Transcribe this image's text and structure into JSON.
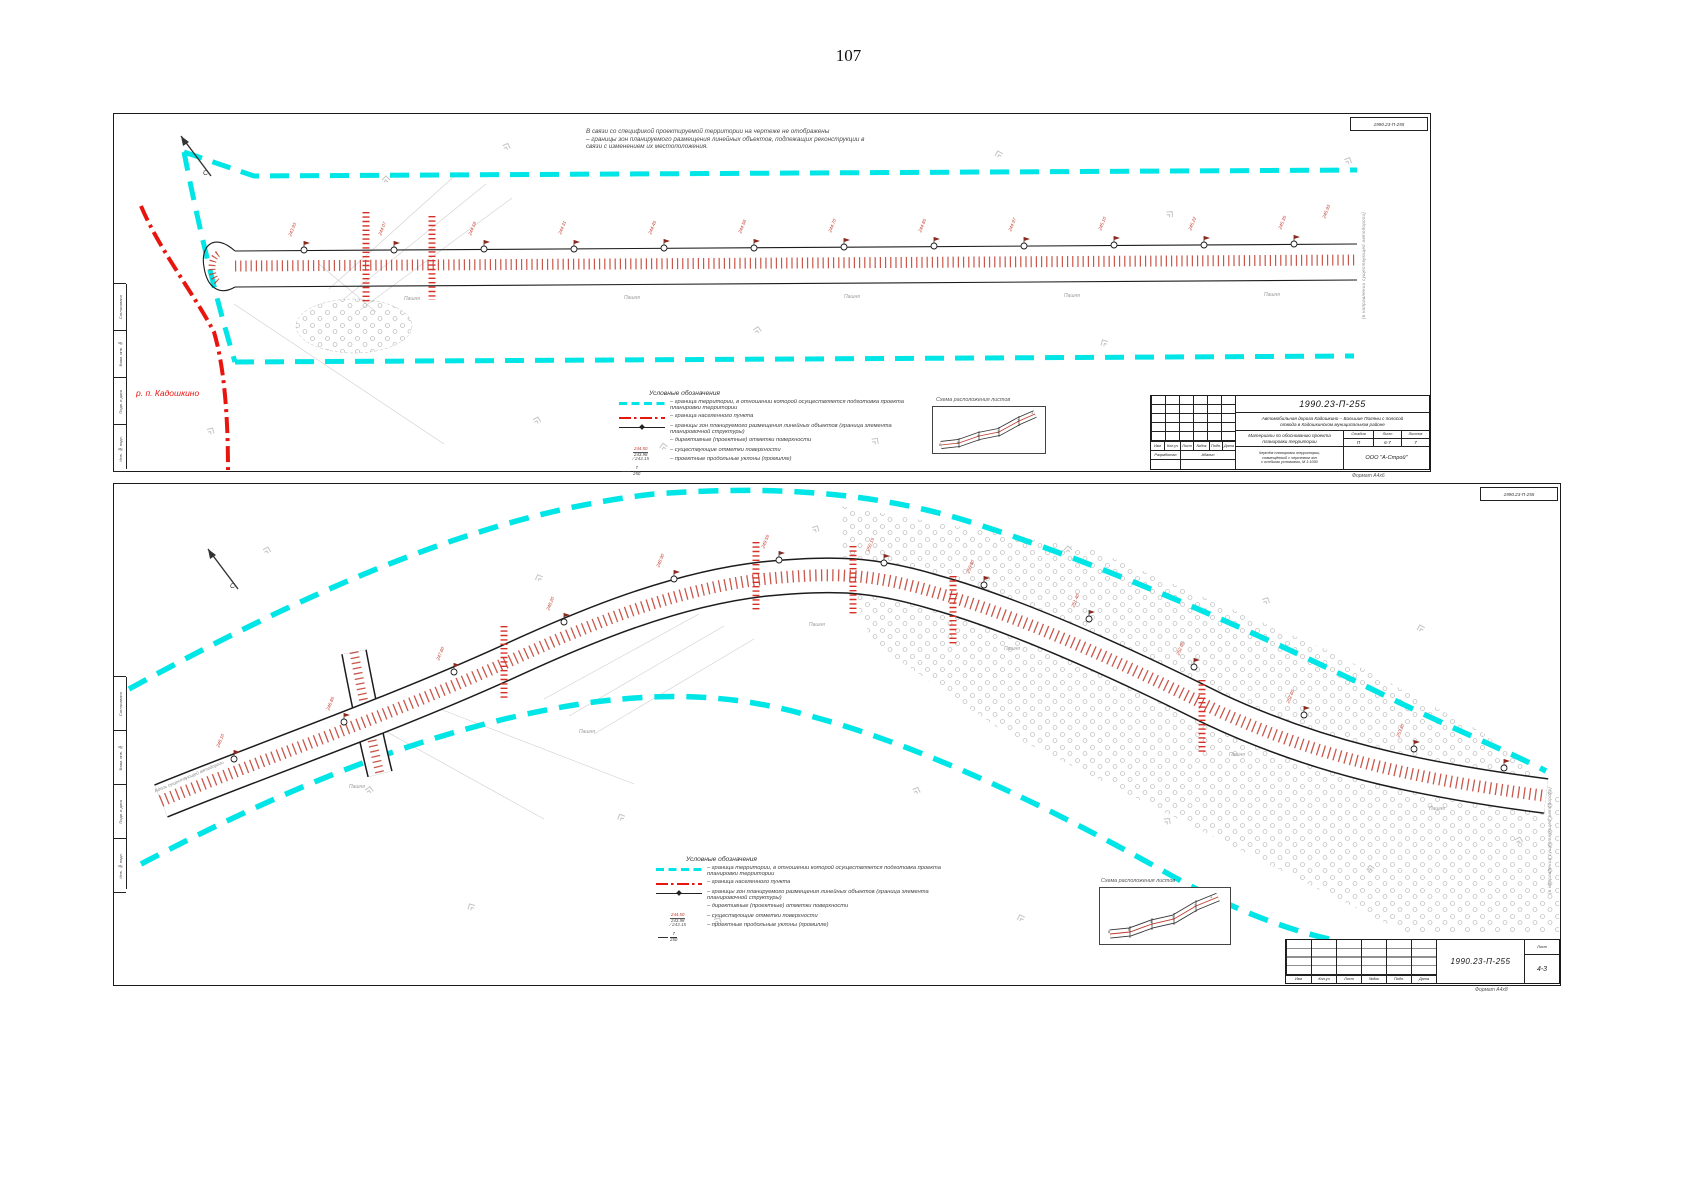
{
  "page": {
    "number": "107"
  },
  "colors": {
    "boundary_cyan": "#00E5E6",
    "settlement_red": "#E8150F",
    "road_hatch_red": "#C0392B",
    "line_black": "#1C1C1C",
    "muted_gray": "#9B9B9B"
  },
  "stamp_labels": {
    "approved": "Согласовано",
    "inv_replace": "Взам. инв. №",
    "sign_date": "Подп. и дата",
    "inv_orig": "Инв. № подл."
  },
  "legend": {
    "title": "Условные обозначения",
    "items": [
      {
        "label": "– граница территории, в отношении которой осуществляется подготовка проекта планировки территории"
      },
      {
        "label": "– граница населенного пункта"
      },
      {
        "label": "– границы зон планируемого размещения линейных объектов (граница элемента планировочной структуры)"
      },
      {
        "label": "– директивные (проектные) отметки поверхности",
        "sample_top": "244.50",
        "sample_bottom": "243.98"
      },
      {
        "label": "– существующие отметки поверхности",
        "sample_top": "243.15"
      },
      {
        "label": "– проектные продольные уклоны (промилле)",
        "sample_top": "7",
        "sample_bottom": "250"
      }
    ]
  },
  "scheme": {
    "title": "Схема расположения листов"
  },
  "sheet1": {
    "note_lines": [
      "В связи со спецификой проектируемой территории на чертеже не отображены",
      "– границы зон планируемого размещения линейных объектов, подлежащих реконструкции в",
      "связи с изменением их местоположения."
    ],
    "settlement_label": "р. п. Кадошкино",
    "north_label": "С",
    "right_edge_label": "(в направлении существующей автодороги)",
    "format_label": "Формат А4х6",
    "titleblock": {
      "doc_number": "1990.23-П-255",
      "project_line1": "Автомобильная дорога Кадошкино – Большие Поляны с полосой",
      "project_line2": "отвода в Кадошкинском муниципальном районе",
      "columns": [
        "Изм",
        "Кол.уч",
        "Лист",
        "№док",
        "Подп.",
        "Дата"
      ],
      "role_label": "Разработал",
      "role_name": "Абанин",
      "doc_title": "Материалы по обоснованию проекта планировки территории",
      "sheet_caption_lines": [
        "Чертёж планировки территории,",
        "совмещённый с чертежом зон",
        "с особыми условиями, М 1:1000"
      ],
      "stage_label": "Стадия",
      "sheet_label": "Лист",
      "sheets_label": "Листов",
      "stage": "П",
      "sheet": "6-7",
      "sheets": "7",
      "org": "ООО \"А-Строй\""
    },
    "stations": [
      {
        "x": 178,
        "y": 118,
        "t": "243.93"
      },
      {
        "x": 268,
        "y": 117,
        "t": "244.07"
      },
      {
        "x": 358,
        "y": 117,
        "t": "244.18"
      },
      {
        "x": 448,
        "y": 116,
        "t": "244.31"
      },
      {
        "x": 538,
        "y": 116,
        "t": "244.45"
      },
      {
        "x": 628,
        "y": 115,
        "t": "244.58"
      },
      {
        "x": 718,
        "y": 114,
        "t": "244.70"
      },
      {
        "x": 808,
        "y": 114,
        "t": "244.85"
      },
      {
        "x": 898,
        "y": 113,
        "t": "244.97"
      },
      {
        "x": 988,
        "y": 112,
        "t": "245.10"
      },
      {
        "x": 1078,
        "y": 112,
        "t": "245.22"
      },
      {
        "x": 1168,
        "y": 111,
        "t": "245.35"
      },
      {
        "x": 1212,
        "y": 100,
        "t": "245.93"
      }
    ],
    "landuse": [
      {
        "x": 290,
        "y": 182,
        "t": "Пашня"
      },
      {
        "x": 510,
        "y": 181,
        "t": "Пашня"
      },
      {
        "x": 730,
        "y": 180,
        "t": "Пашня"
      },
      {
        "x": 950,
        "y": 179,
        "t": "Пашня"
      },
      {
        "x": 1150,
        "y": 178,
        "t": "Пашня"
      }
    ],
    "scheme_nums": [
      {
        "x": 6,
        "y": 36,
        "t": "6"
      },
      {
        "x": 24,
        "y": 34,
        "t": "5"
      },
      {
        "x": 44,
        "y": 27,
        "t": "4"
      },
      {
        "x": 64,
        "y": 23,
        "t": "3"
      },
      {
        "x": 84,
        "y": 12,
        "t": "2"
      },
      {
        "x": 98,
        "y": 4,
        "t": "1"
      }
    ]
  },
  "sheet2": {
    "north_label": "С",
    "along_road_label": "Вдоль существующей автодороги",
    "right_edge_label": "(в направлении существующей автодороги)",
    "format_label": "Формат А4х8",
    "titleblock": {
      "doc_number": "1990.23-П-255",
      "columns": [
        "Изм",
        "Кол.уч",
        "Лист",
        "№док",
        "Подп.",
        "Дата"
      ],
      "sheet_label": "Лист",
      "sheet": "4-3"
    },
    "stations": [
      {
        "x": 106,
        "y": 259,
        "t": "246.10"
      },
      {
        "x": 216,
        "y": 222,
        "t": "246.85"
      },
      {
        "x": 326,
        "y": 172,
        "t": "247.60"
      },
      {
        "x": 436,
        "y": 122,
        "t": "248.20"
      },
      {
        "x": 546,
        "y": 79,
        "t": "248.90"
      },
      {
        "x": 651,
        "y": 60,
        "t": "249.55"
      },
      {
        "x": 756,
        "y": 63,
        "t": "250.15"
      },
      {
        "x": 856,
        "y": 85,
        "t": "250.80"
      },
      {
        "x": 961,
        "y": 119,
        "t": "251.40"
      },
      {
        "x": 1066,
        "y": 167,
        "t": "252.05"
      },
      {
        "x": 1176,
        "y": 215,
        "t": "252.60"
      },
      {
        "x": 1286,
        "y": 249,
        "t": "253.10"
      }
    ],
    "landuse": [
      {
        "x": 235,
        "y": 300,
        "t": "Пашня"
      },
      {
        "x": 465,
        "y": 245,
        "t": "Пашня"
      },
      {
        "x": 695,
        "y": 138,
        "t": "Пашня"
      },
      {
        "x": 890,
        "y": 162,
        "t": "Пашня"
      },
      {
        "x": 1115,
        "y": 268,
        "t": "Пашня"
      },
      {
        "x": 1315,
        "y": 322,
        "t": "Пашня"
      }
    ],
    "scheme_nums": [
      {
        "x": 8,
        "y": 42,
        "t": "6"
      },
      {
        "x": 28,
        "y": 40,
        "t": "5"
      },
      {
        "x": 50,
        "y": 32,
        "t": "4"
      },
      {
        "x": 72,
        "y": 28,
        "t": "3"
      },
      {
        "x": 94,
        "y": 16,
        "t": "2"
      },
      {
        "x": 110,
        "y": 7,
        "t": "1"
      }
    ]
  }
}
